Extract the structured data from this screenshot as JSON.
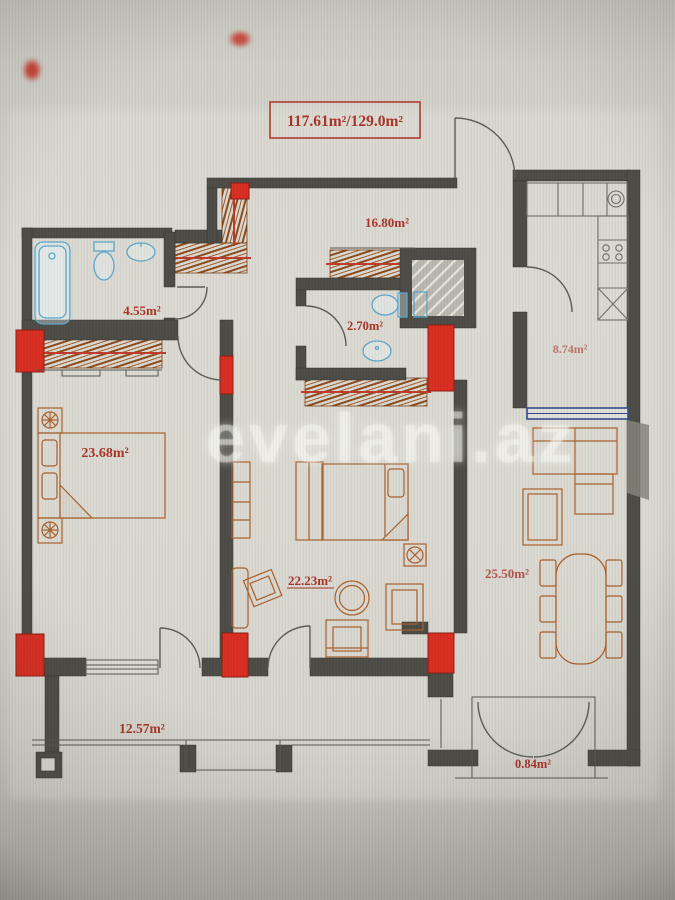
{
  "photo": {
    "watermark": "evelani.az"
  },
  "title": {
    "total_area": "117.61m²/129.0m²"
  },
  "rooms": [
    {
      "id": "hall",
      "area": "16.80m²"
    },
    {
      "id": "bathroom",
      "area": "4.55m²"
    },
    {
      "id": "wc",
      "area": "2.70m²"
    },
    {
      "id": "kitchen",
      "area": "8.74m²"
    },
    {
      "id": "bedroom",
      "area": "23.68m²"
    },
    {
      "id": "living-room",
      "area": "22.23m²"
    },
    {
      "id": "lounge-dining",
      "area": "25.50m²"
    },
    {
      "id": "balcony",
      "area": "12.57m²"
    },
    {
      "id": "french-balcony",
      "area": "0.84m²"
    }
  ],
  "colors": {
    "wall": "#4b4a44",
    "column_red": "#d92c1f",
    "furniture_orange": "#a95f2a",
    "hatch_brown": "#8a4a1c",
    "fixture_blue": "#5aa8cd",
    "window_blue": "#32488c",
    "label_red": "#a93226"
  }
}
